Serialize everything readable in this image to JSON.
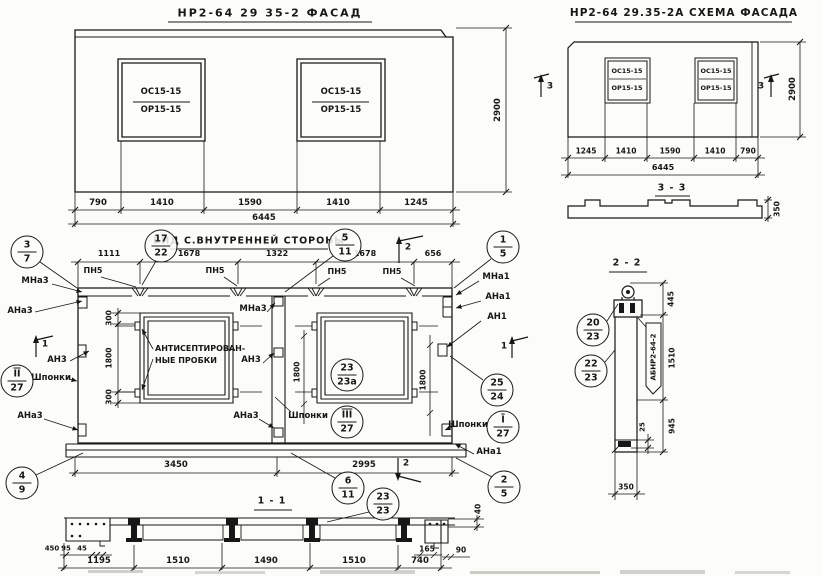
{
  "facade": {
    "title": "НР2-64 29 35-2 ФАСАД",
    "win_top": "ОС15-15",
    "win_bot": "ОР15-15",
    "dims_bottom": [
      "790",
      "1410",
      "1590",
      "1410",
      "1245"
    ],
    "dim_total": "6445",
    "dim_height": "2900"
  },
  "schema": {
    "title": "НР2-64 29.35-2А СХЕМА ФАСАДА",
    "win_top": "ОС15-15",
    "win_bot": "ОР15-15",
    "dims_bottom": [
      "1245",
      "1410",
      "1590",
      "1410",
      "790"
    ],
    "dim_total": "6445",
    "dim_height": "2900",
    "marker": "3",
    "section33_title": "3 - 3",
    "section33_height": "350"
  },
  "view": {
    "title": "ВИД С.ВНУТРЕННЕЙ СТОРОНЫ",
    "dims_top": [
      "1111",
      "1678",
      "1322",
      "1678",
      "656"
    ],
    "dim_300": "300",
    "dim_1800": "1800",
    "dim_3450": "3450",
    "dim_2995": "2995",
    "label_pn5": "ПН5",
    "label_mna3": "МНа3",
    "label_ana3": "АНа3",
    "label_an3": "АН3",
    "label_mna1": "МНа1",
    "label_ana1": "АНа1",
    "label_an1": "АН1",
    "label_shponki": "Шпонки",
    "plugs_line1": "АНТИСЕПТИРОВАН-",
    "plugs_line2": "НЫЕ ПРОБКИ",
    "marker1": "1",
    "marker2": "2"
  },
  "sec11": {
    "title": "1 - 1",
    "dims": [
      "1195",
      "1510",
      "1490",
      "1510",
      "740"
    ],
    "dim_450": "450",
    "dim_95": "95",
    "dim_45": "45",
    "dim_165": "165",
    "dim_90": "90",
    "dim_40": "40"
  },
  "sec22": {
    "title": "2 - 2",
    "dim_445": "445",
    "dim_1510": "1510",
    "dim_945": "945",
    "dim_25": "25",
    "dim_350": "350",
    "stamp": "АБНР2-64-2"
  },
  "callouts": {
    "c3_7": {
      "top": "3",
      "bot": "7"
    },
    "c17_22": {
      "top": "17",
      "bot": "22"
    },
    "c5_11": {
      "top": "5",
      "bot": "11"
    },
    "c1_5": {
      "top": "1",
      "bot": "5"
    },
    "cII_27": {
      "top": "II",
      "bot": "27"
    },
    "cIII_27": {
      "top": "III",
      "bot": "27"
    },
    "cI_27": {
      "top": "I",
      "bot": "27"
    },
    "c23_23a": {
      "top": "23",
      "bot": "23а"
    },
    "c25_24": {
      "top": "25",
      "bot": "24"
    },
    "c4_9": {
      "top": "4",
      "bot": "9"
    },
    "c6_11": {
      "top": "6",
      "bot": "11"
    },
    "c2_5": {
      "top": "2",
      "bot": "5"
    },
    "c23_23": {
      "top": "23",
      "bot": "23"
    },
    "c20_23": {
      "top": "20",
      "bot": "23"
    },
    "c22_23": {
      "top": "22",
      "bot": "23"
    }
  }
}
